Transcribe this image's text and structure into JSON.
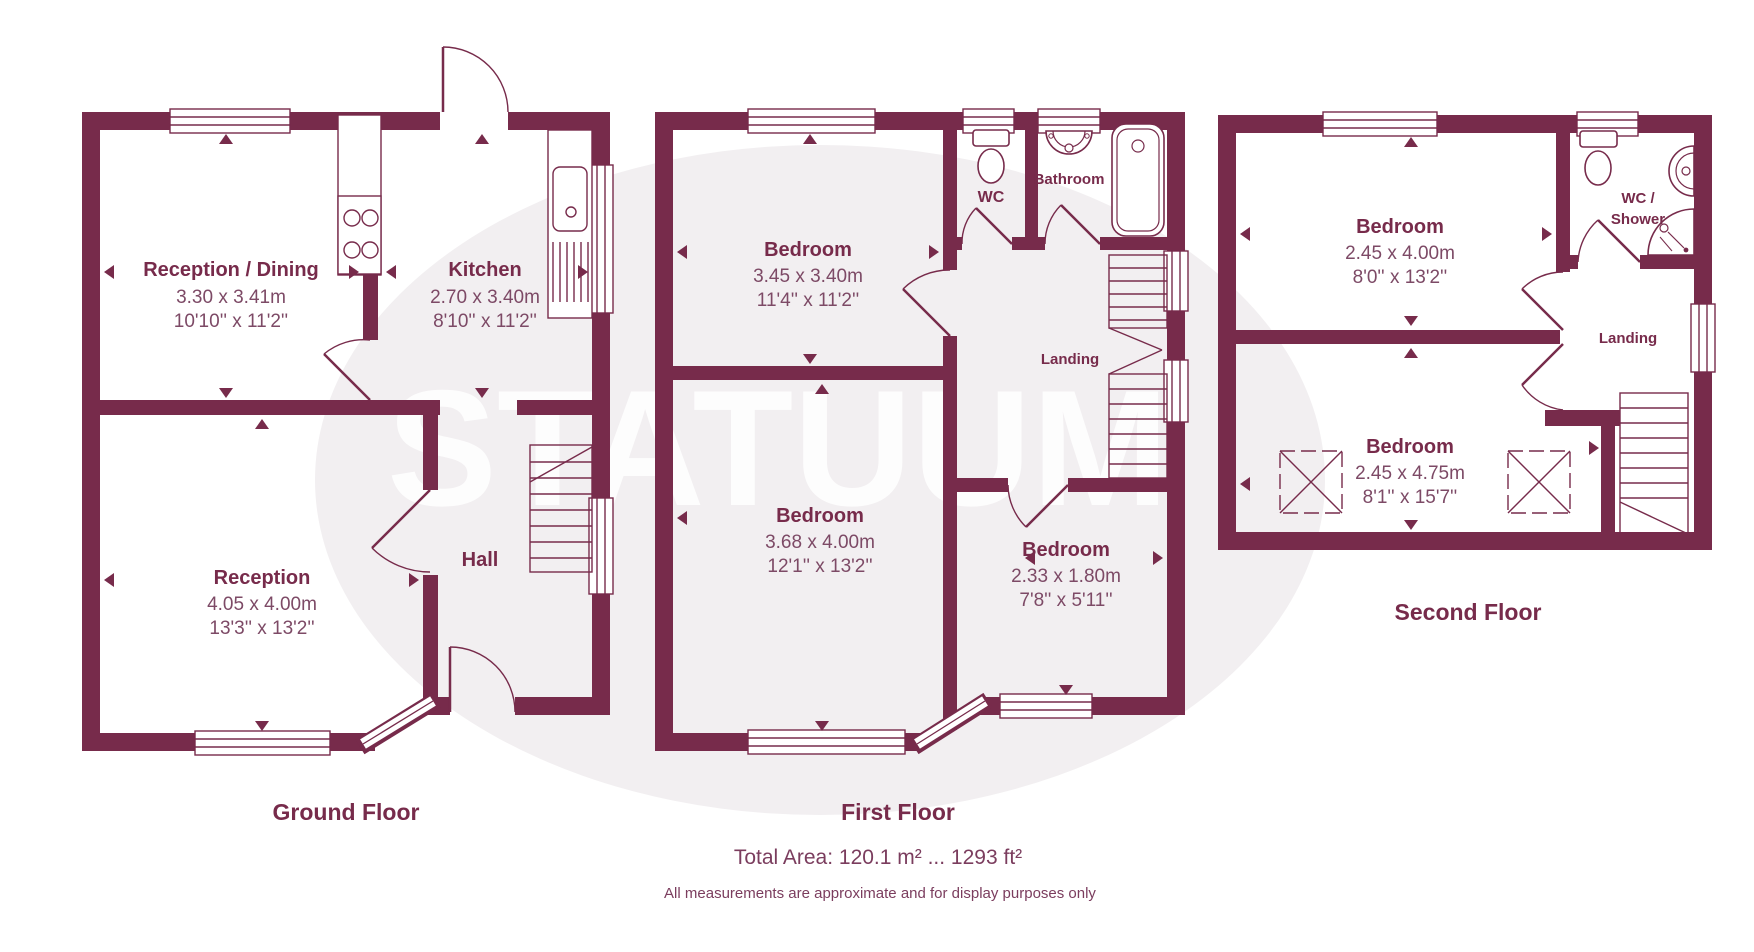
{
  "watermark": {
    "text": "STATUUM"
  },
  "colors": {
    "wall": "#772b4b",
    "dim_text": "#7d4a66",
    "watermark_circle": "#f2eff1"
  },
  "footer": {
    "total_area": "Total Area: 120.1 m² ... 1293 ft²",
    "disclaimer": "All measurements are approximate and for display purposes only"
  },
  "floors": {
    "ground": {
      "label": "Ground Floor",
      "rooms": {
        "reception_dining": {
          "name": "Reception / Dining",
          "metric": "3.30 x 3.41m",
          "imperial": "10'10'' x 11'2''"
        },
        "kitchen": {
          "name": "Kitchen",
          "metric": "2.70 x 3.40m",
          "imperial": "8'10'' x 11'2''"
        },
        "reception": {
          "name": "Reception",
          "metric": "4.05 x 4.00m",
          "imperial": "13'3'' x 13'2''"
        },
        "hall": {
          "name": "Hall"
        }
      }
    },
    "first": {
      "label": "First Floor",
      "rooms": {
        "bedroom_front": {
          "name": "Bedroom",
          "metric": "3.45 x 3.40m",
          "imperial": "11'4'' x 11'2''"
        },
        "wc": {
          "name": "WC"
        },
        "bathroom": {
          "name": "Bathroom"
        },
        "landing": {
          "name": "Landing"
        },
        "bedroom_back": {
          "name": "Bedroom",
          "metric": "3.68 x 4.00m",
          "imperial": "12'1'' x 13'2''"
        },
        "bedroom_small": {
          "name": "Bedroom",
          "metric": "2.33 x 1.80m",
          "imperial": "7'8'' x 5'11''"
        }
      }
    },
    "second": {
      "label": "Second Floor",
      "rooms": {
        "bedroom_front": {
          "name": "Bedroom",
          "metric": "2.45 x 4.00m",
          "imperial": "8'0'' x 13'2''"
        },
        "wc_shower": {
          "line1": "WC /",
          "line2": "Shower"
        },
        "landing": {
          "name": "Landing"
        },
        "bedroom_back": {
          "name": "Bedroom",
          "metric": "2.45 x 4.75m",
          "imperial": "8'1'' x 15'7''"
        }
      }
    }
  }
}
